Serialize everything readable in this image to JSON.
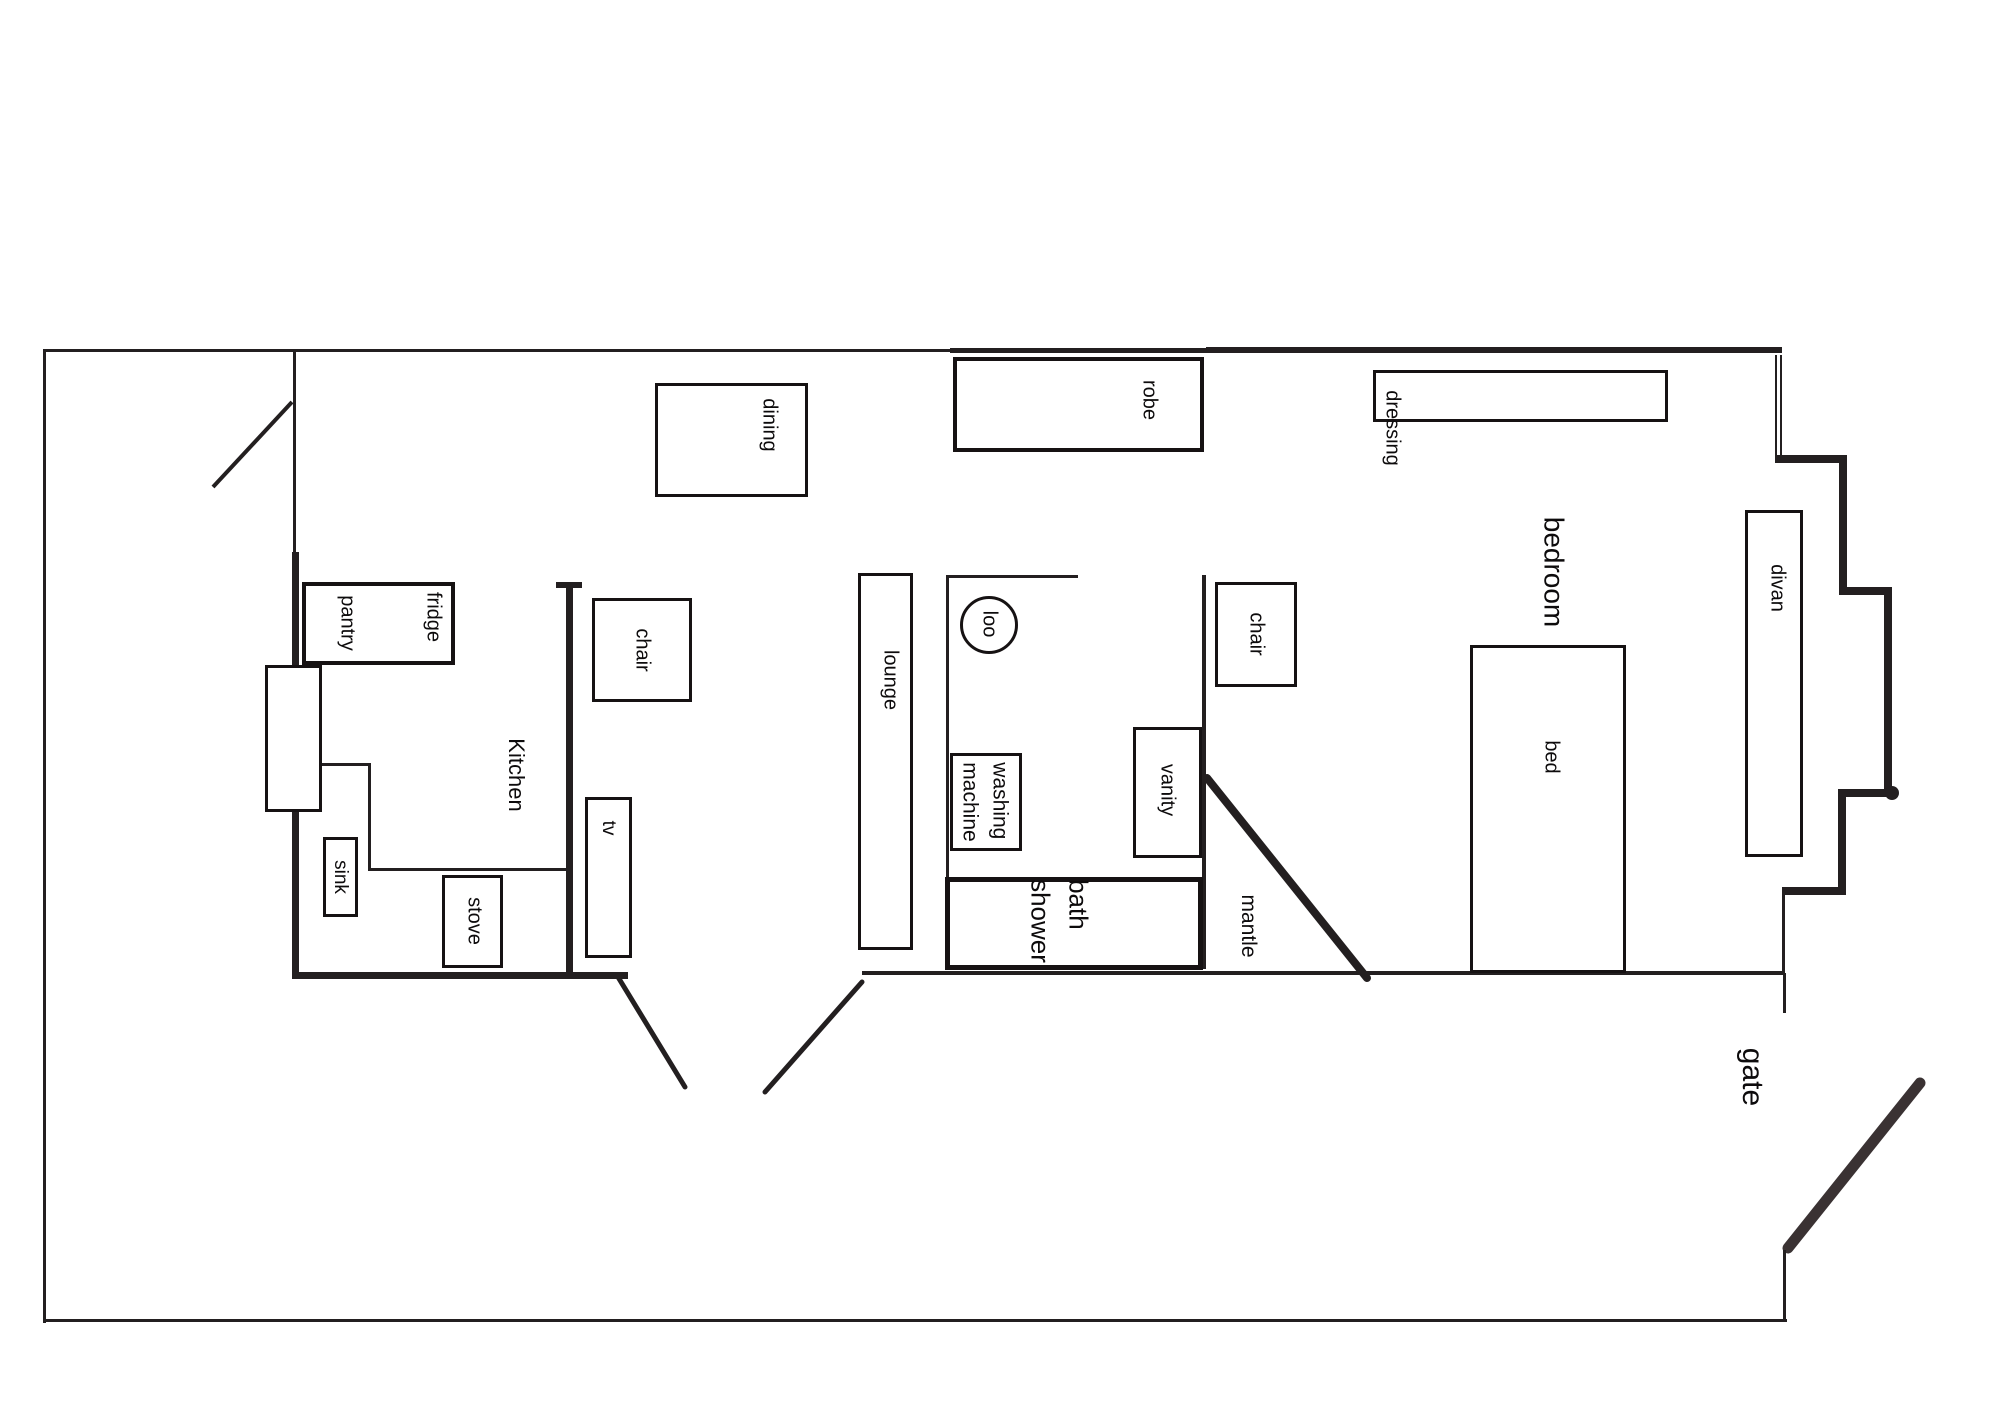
{
  "title": "floor plan",
  "canvas": {
    "width": 2000,
    "height": 1414,
    "background": "#ffffff",
    "ink": "#231f20",
    "accent": "#3a3233"
  },
  "labels": [
    {
      "name": "room-label-kitchen",
      "text": "Kitchen",
      "x": 516,
      "y": 775,
      "font": 22
    },
    {
      "name": "room-label-bedroom",
      "text": "bedroom",
      "x": 1553,
      "y": 572,
      "font": 28
    },
    {
      "name": "room-label-gate",
      "text": "gate",
      "x": 1752,
      "y": 1077,
      "font": 30
    },
    {
      "name": "room-label-mantle",
      "text": "mantle",
      "x": 1248,
      "y": 926,
      "font": 21
    },
    {
      "name": "furniture-label-dining",
      "text": "dining",
      "x": 769,
      "y": 425,
      "font": 20
    },
    {
      "name": "furniture-label-pantry",
      "text": "pantry",
      "x": 347,
      "y": 623,
      "font": 20
    },
    {
      "name": "furniture-label-fridge",
      "text": "fridge",
      "x": 433,
      "y": 617,
      "font": 20
    },
    {
      "name": "furniture-label-sink",
      "text": "sink",
      "x": 340,
      "y": 877,
      "font": 19
    },
    {
      "name": "furniture-label-stove",
      "text": "stove",
      "x": 474,
      "y": 921,
      "font": 20
    },
    {
      "name": "furniture-label-chair-kitchen",
      "text": "chair",
      "x": 642,
      "y": 650,
      "font": 20
    },
    {
      "name": "furniture-label-tv",
      "text": "tv",
      "x": 608,
      "y": 828,
      "font": 19
    },
    {
      "name": "furniture-label-lounge",
      "text": "lounge",
      "x": 890,
      "y": 680,
      "font": 20
    },
    {
      "name": "furniture-label-robe",
      "text": "robe",
      "x": 1149,
      "y": 400,
      "font": 20
    },
    {
      "name": "furniture-label-dressing",
      "text": "dressing",
      "x": 1392,
      "y": 428,
      "font": 20
    },
    {
      "name": "fixture-label-loo",
      "text": "loo",
      "x": 989,
      "y": 624,
      "font": 20
    },
    {
      "name": "furniture-label-washing-machine",
      "text": "washing\nmachine",
      "x": 984,
      "y": 802,
      "font": 21
    },
    {
      "name": "furniture-label-vanity",
      "text": "vanity",
      "x": 1167,
      "y": 790,
      "font": 20
    },
    {
      "name": "furniture-label-chair-bedroom",
      "text": "chair",
      "x": 1256,
      "y": 634,
      "font": 20
    },
    {
      "name": "fixture-label-bath-shower",
      "text": "bath\nshower",
      "x": 1059,
      "y": 921,
      "font": 26
    },
    {
      "name": "furniture-label-bed",
      "text": "bed",
      "x": 1551,
      "y": 757,
      "font": 20
    },
    {
      "name": "furniture-label-divan",
      "text": "divan",
      "x": 1777,
      "y": 588,
      "font": 20
    }
  ],
  "boxes": [
    {
      "name": "furniture-pantry-fridge",
      "x": 302,
      "y": 582,
      "w": 153,
      "h": 83,
      "border": 4
    },
    {
      "name": "furniture-cupboard",
      "x": 265,
      "y": 665,
      "w": 57,
      "h": 147,
      "border": 3
    },
    {
      "name": "furniture-sink",
      "x": 323,
      "y": 837,
      "w": 35,
      "h": 80,
      "border": 3
    },
    {
      "name": "furniture-stove",
      "x": 442,
      "y": 875,
      "w": 61,
      "h": 93,
      "border": 3
    },
    {
      "name": "furniture-dining-table",
      "x": 655,
      "y": 383,
      "w": 153,
      "h": 114,
      "border": 3
    },
    {
      "name": "furniture-chair-kitchen",
      "x": 592,
      "y": 598,
      "w": 100,
      "h": 104,
      "border": 3
    },
    {
      "name": "furniture-tv",
      "x": 585,
      "y": 797,
      "w": 47,
      "h": 161,
      "border": 3
    },
    {
      "name": "furniture-lounge",
      "x": 858,
      "y": 573,
      "w": 55,
      "h": 377,
      "border": 3
    },
    {
      "name": "furniture-robe",
      "x": 953,
      "y": 357,
      "w": 251,
      "h": 95,
      "border": 4
    },
    {
      "name": "furniture-dressing-table",
      "x": 1373,
      "y": 370,
      "w": 295,
      "h": 52,
      "border": 3
    },
    {
      "name": "furniture-washing-machine",
      "x": 950,
      "y": 753,
      "w": 72,
      "h": 98,
      "border": 3
    },
    {
      "name": "furniture-vanity",
      "x": 1133,
      "y": 727,
      "w": 69,
      "h": 131,
      "border": 3
    },
    {
      "name": "furniture-chair-bedroom",
      "x": 1215,
      "y": 582,
      "w": 82,
      "h": 105,
      "border": 3
    },
    {
      "name": "fixture-bath-shower",
      "x": 945,
      "y": 877,
      "w": 258,
      "h": 93,
      "border": 5
    },
    {
      "name": "furniture-bed",
      "x": 1470,
      "y": 645,
      "w": 156,
      "h": 328,
      "border": 3
    },
    {
      "name": "furniture-divan",
      "x": 1745,
      "y": 510,
      "w": 58,
      "h": 347,
      "border": 3
    }
  ],
  "circles": [
    {
      "name": "fixture-loo",
      "cx": 989,
      "cy": 625,
      "r": 29,
      "stroke": 3
    }
  ],
  "blobs": [
    {
      "name": "wall-joint-blob",
      "cx": 1892,
      "cy": 793,
      "r": 7
    }
  ],
  "walls": [
    {
      "name": "yard-wall-left",
      "x": 43,
      "y": 349,
      "w": 3,
      "h": 974
    },
    {
      "name": "yard-wall-top-west",
      "x": 43,
      "y": 349,
      "w": 910,
      "h": 3
    },
    {
      "name": "house-wall-top-mid",
      "x": 950,
      "y": 348,
      "w": 260,
      "h": 5
    },
    {
      "name": "house-wall-top-east",
      "x": 1206,
      "y": 347,
      "w": 576,
      "h": 6
    },
    {
      "name": "yard-wall-bottom",
      "x": 43,
      "y": 1319,
      "w": 1744,
      "h": 3
    },
    {
      "name": "yard-wall-right-upper",
      "x": 1783,
      "y": 973,
      "w": 3,
      "h": 40
    },
    {
      "name": "yard-wall-right-lower",
      "x": 1783,
      "y": 1250,
      "w": 3,
      "h": 72
    },
    {
      "name": "house-wall-west-thin",
      "x": 293,
      "y": 352,
      "w": 3,
      "h": 200
    },
    {
      "name": "house-wall-west-thick",
      "x": 292,
      "y": 552,
      "w": 7,
      "h": 427
    },
    {
      "name": "house-wall-south-west",
      "x": 292,
      "y": 972,
      "w": 336,
      "h": 7
    },
    {
      "name": "house-wall-south-east",
      "x": 862,
      "y": 971,
      "w": 922,
      "h": 4
    },
    {
      "name": "kitchen-divider-wall",
      "x": 566,
      "y": 584,
      "w": 7,
      "h": 395
    },
    {
      "name": "kitchen-divider-cap",
      "x": 556,
      "y": 582,
      "w": 26,
      "h": 6
    },
    {
      "name": "kitchen-counter-top",
      "x": 322,
      "y": 763,
      "w": 48,
      "h": 3
    },
    {
      "name": "kitchen-counter-side",
      "x": 368,
      "y": 763,
      "w": 3,
      "h": 108
    },
    {
      "name": "kitchen-counter-bottom",
      "x": 368,
      "y": 868,
      "w": 200,
      "h": 3
    },
    {
      "name": "bathroom-wall-top",
      "x": 948,
      "y": 575,
      "w": 130,
      "h": 3
    },
    {
      "name": "bathroom-wall-left",
      "x": 946,
      "y": 575,
      "w": 3,
      "h": 302
    },
    {
      "name": "bedroom-wall-west",
      "x": 1202,
      "y": 575,
      "w": 4,
      "h": 394
    },
    {
      "name": "window-right-outer",
      "x": 1775,
      "y": 355,
      "w": 2,
      "h": 103
    },
    {
      "name": "window-right-inner",
      "x": 1780,
      "y": 355,
      "w": 2,
      "h": 103
    },
    {
      "name": "bay-step-h1",
      "x": 1775,
      "y": 455,
      "w": 72,
      "h": 8
    },
    {
      "name": "bay-step-v1",
      "x": 1839,
      "y": 455,
      "w": 8,
      "h": 140
    },
    {
      "name": "bay-step-h2",
      "x": 1839,
      "y": 587,
      "w": 53,
      "h": 8
    },
    {
      "name": "bay-step-v2",
      "x": 1884,
      "y": 587,
      "w": 8,
      "h": 208
    },
    {
      "name": "bay-step-h3",
      "x": 1838,
      "y": 789,
      "w": 58,
      "h": 8
    },
    {
      "name": "bay-step-v3",
      "x": 1838,
      "y": 789,
      "w": 8,
      "h": 106
    },
    {
      "name": "bay-step-h4",
      "x": 1782,
      "y": 887,
      "w": 64,
      "h": 8
    },
    {
      "name": "bay-step-v4",
      "x": 1782,
      "y": 887,
      "w": 3,
      "h": 88
    }
  ],
  "doors": [
    {
      "name": "door-swing-yard-entry",
      "x1": 213,
      "y1": 487,
      "x2": 292,
      "y2": 402,
      "width": 4,
      "cap": "butt",
      "color": "#231f20"
    },
    {
      "name": "door-swing-patio-left",
      "x1": 618,
      "y1": 977,
      "x2": 685,
      "y2": 1087,
      "width": 5,
      "cap": "round",
      "color": "#231f20"
    },
    {
      "name": "door-swing-patio-right",
      "x1": 862,
      "y1": 982,
      "x2": 765,
      "y2": 1092,
      "width": 5,
      "cap": "round",
      "color": "#231f20"
    },
    {
      "name": "mantle-diagonal",
      "x1": 1207,
      "y1": 778,
      "x2": 1367,
      "y2": 978,
      "width": 8,
      "cap": "round",
      "color": "#231f20"
    },
    {
      "name": "gate-door-swing",
      "x1": 1788,
      "y1": 1248,
      "x2": 1920,
      "y2": 1083,
      "width": 11,
      "cap": "round",
      "color": "#3a3233"
    }
  ]
}
